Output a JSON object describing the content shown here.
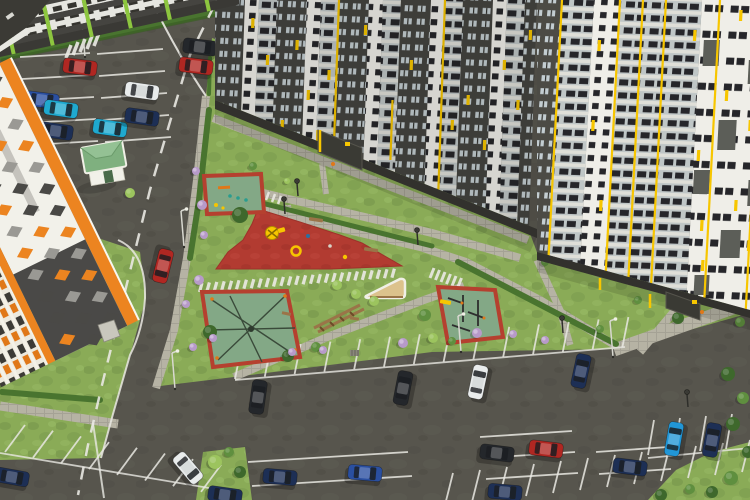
{
  "meta": {
    "description": "Aerial 3D architectural render of a residential complex: courtyard with red rubber playgrounds, sports courts, lawns, footpaths, a kiosk with a green roof, and two parking lots with cars between tall apartment towers",
    "image_type": "photorealistic-render",
    "visible_text": ""
  },
  "palette": {
    "asphalt": "#57554d",
    "asphalt_light": "#64625a",
    "grass": "#8aab57",
    "grass_dark": "#74944a",
    "grass_light": "#9cc06a",
    "hedge": "#49742f",
    "hedge_dark": "#3a5e24",
    "path": "#b6b3a4",
    "path_light": "#cecbbd",
    "line_white": "#e9e8e2",
    "red_surface": "#b23b31",
    "red_surface_dark": "#9e322a",
    "court_red": "#b5402f",
    "court_green": "#83a886",
    "sand": "#dcc28c",
    "wood": "#9a7448",
    "wood_dark": "#6b4c28",
    "tower_dark": "#454440",
    "tower_dark2": "#4c4b45",
    "tower_plinth": "#32312d",
    "tower_white": "#efeee8",
    "glass": "#c3cdd1",
    "balcony": "#bfc6c6",
    "balcony_slab": "#dfdfd8",
    "window_dark": "#26262a",
    "yellow": "#f7c600",
    "orange": "#ec8420",
    "lime": "#8dc63f",
    "kiosk_roof": "#7fb07f",
    "kiosk_roof_light": "#94c194",
    "kiosk_wall": "#f2f1e9",
    "car": {
      "red": "#b02722",
      "cyan": "#1fa9cf",
      "navy": "#1d2f55",
      "blue": "#2a4fa0",
      "white": "#e9ecec",
      "black": "#24272b",
      "skyblue": "#2196d6"
    },
    "veg": {
      "dark": "#3e682c",
      "mid": "#5f8f3f",
      "light": "#9cc45e",
      "lilac": "#b79ac9"
    }
  },
  "scene": {
    "buildings": [
      {
        "id": "left-tower",
        "style": "white facade, orange stripes, gray/orange diamond pattern, orange-and-dark window floors"
      },
      {
        "id": "lowrise-top",
        "style": "dark gray facade, white window bands, lime green vertical accents"
      },
      {
        "id": "center-tower",
        "style": "dark gray and white vertical sections, glazed balcony columns, yellow accents"
      },
      {
        "id": "right-tower",
        "style": "light facade, gray balcony bands, white piers, dark patches, yellow vertical stripes"
      },
      {
        "id": "kiosk",
        "style": "small white kiosk with green hip roof"
      }
    ],
    "courtyard": {
      "red_playground": "large red rubber play area with yellow climbing frame, ring, benches and toys",
      "kids_court": "small red-framed green court with bench and play items",
      "net_court": "red-framed green court with rope climbing nets",
      "workout_court": "red-framed green court with workout bars and bench",
      "sand_pit": "triangular sand pit with wooden edge",
      "obstacle": "wooden balance/obstacle beams on lawn"
    },
    "cars": [
      [
        80,
        67,
        7,
        "red"
      ],
      [
        196,
        66,
        7,
        "red"
      ],
      [
        200,
        47,
        7,
        "black"
      ],
      [
        42,
        100,
        7,
        "blue"
      ],
      [
        61,
        109,
        8,
        "cyan"
      ],
      [
        56,
        131,
        8,
        "navy"
      ],
      [
        110,
        128,
        8,
        "cyan"
      ],
      [
        142,
        91,
        8,
        "white"
      ],
      [
        142,
        117,
        8,
        "navy"
      ],
      [
        163,
        266,
        104,
        "red"
      ],
      [
        188,
        468,
        50,
        "white"
      ],
      [
        403,
        388,
        -79,
        "black"
      ],
      [
        581,
        371,
        -78,
        "navy"
      ],
      [
        478,
        382,
        -78,
        "white"
      ],
      [
        258,
        397,
        -82,
        "black"
      ],
      [
        280,
        477,
        5,
        "navy"
      ],
      [
        365,
        473,
        5,
        "blue"
      ],
      [
        546,
        449,
        7,
        "red"
      ],
      [
        497,
        453,
        7,
        "black"
      ],
      [
        674,
        439,
        -80,
        "skyblue"
      ],
      [
        712,
        440,
        -80,
        "navy"
      ],
      [
        630,
        467,
        7,
        "navy"
      ],
      [
        505,
        492,
        5,
        "navy"
      ],
      [
        225,
        495,
        8,
        "navy"
      ],
      [
        12,
        477,
        10,
        "navy"
      ]
    ],
    "vegetation": [
      [
        240,
        215,
        8,
        "dark"
      ],
      [
        210,
        332,
        7,
        "dark"
      ],
      [
        288,
        356,
        6,
        "dark"
      ],
      [
        316,
        347,
        5,
        "mid"
      ],
      [
        678,
        318,
        6,
        "dark"
      ],
      [
        740,
        322,
        5,
        "mid"
      ],
      [
        728,
        374,
        7,
        "dark"
      ],
      [
        743,
        398,
        6,
        "mid"
      ],
      [
        733,
        424,
        7,
        "dark"
      ],
      [
        748,
        452,
        6,
        "dark"
      ],
      [
        731,
        478,
        7,
        "mid"
      ],
      [
        712,
        492,
        6,
        "dark"
      ],
      [
        690,
        489,
        5,
        "mid"
      ],
      [
        661,
        495,
        6,
        "dark"
      ],
      [
        196,
        171,
        4,
        "lilac"
      ],
      [
        202,
        205,
        5,
        "lilac"
      ],
      [
        204,
        235,
        4,
        "lilac"
      ],
      [
        199,
        280,
        5,
        "lilac"
      ],
      [
        213,
        338,
        4,
        "lilac"
      ],
      [
        292,
        352,
        4,
        "lilac"
      ],
      [
        323,
        350,
        4,
        "lilac"
      ],
      [
        403,
        343,
        5,
        "lilac"
      ],
      [
        477,
        333,
        5,
        "lilac"
      ],
      [
        513,
        334,
        4,
        "lilac"
      ],
      [
        186,
        304,
        4,
        "lilac"
      ],
      [
        193,
        347,
        4,
        "lilac"
      ],
      [
        545,
        340,
        4,
        "lilac"
      ],
      [
        337,
        285,
        5,
        "light"
      ],
      [
        356,
        294,
        5,
        "light"
      ],
      [
        374,
        301,
        5,
        "light"
      ],
      [
        433,
        338,
        5,
        "light"
      ],
      [
        452,
        341,
        4,
        "mid"
      ],
      [
        545,
        262,
        4,
        "mid"
      ],
      [
        638,
        300,
        4,
        "mid"
      ],
      [
        253,
        166,
        4,
        "mid"
      ],
      [
        130,
        193,
        5,
        "light"
      ],
      [
        425,
        315,
        6,
        "mid"
      ],
      [
        115,
        300,
        6,
        "mid"
      ],
      [
        86,
        330,
        5,
        "light"
      ],
      [
        215,
        462,
        7,
        "light"
      ],
      [
        229,
        452,
        5,
        "mid"
      ],
      [
        240,
        472,
        6,
        "dark"
      ],
      [
        287,
        181,
        3,
        "light"
      ],
      [
        600,
        329,
        4,
        "mid"
      ]
    ],
    "lamps": {
      "mast": [
        [
          85,
          57
        ],
        [
          184,
          247
        ],
        [
          175,
          389
        ],
        [
          613,
          357
        ],
        [
          461,
          352
        ]
      ],
      "park": [
        [
          285,
          214
        ],
        [
          418,
          245
        ],
        [
          563,
          333
        ],
        [
          688,
          407
        ],
        [
          298,
          196
        ]
      ]
    },
    "parking": {
      "rows": [
        [
          20,
          57,
          90,
          53,
          5,
          2,
          22
        ],
        [
          97,
          54,
          163,
          49,
          5,
          2,
          22
        ],
        [
          235,
          379,
          241,
          349,
          14,
          29.8,
          -2.46
        ],
        [
          5,
          452,
          25,
          425,
          8,
          28,
          5.7
        ],
        [
          648,
          455,
          654,
          420,
          5,
          26,
          -2
        ],
        [
          480,
          437,
          572,
          431,
          3,
          3,
          21
        ],
        [
          596,
          452,
          668,
          447,
          2,
          3,
          22
        ],
        [
          248,
          462,
          408,
          452,
          2,
          4,
          24
        ],
        [
          445,
          505,
          453,
          473,
          12,
          27,
          -3
        ]
      ],
      "baselines": [
        [
          235,
          380,
          625,
          347
        ],
        [
          0,
          453,
          233,
          492
        ],
        [
          648,
          458,
          750,
          448
        ]
      ]
    },
    "markings": {
      "dash_line": "214,6 190,55 172,115 150,190 134,255 118,320 102,385 88,445 78,495",
      "zebras": [
        [
          202,
          283,
          7.4,
          -0.55,
          -2.5,
          9,
          27,
          3.2
        ],
        [
          66,
          58,
          7,
          -3,
          5,
          -13,
          5,
          3.5
        ],
        [
          434,
          268,
          5.5,
          2.0,
          -4,
          10,
          6,
          3
        ],
        [
          263,
          190,
          6,
          2,
          -3,
          8,
          4,
          2.5
        ]
      ]
    },
    "facades": {
      "center_cols": [
        [
          215,
          30,
          "Dark"
        ],
        [
          245,
          14,
          "White"
        ],
        [
          259,
          18,
          "Balc"
        ],
        [
          277,
          30,
          "Dark"
        ],
        [
          307,
          14,
          "White"
        ],
        [
          321,
          18,
          "Balc"
        ],
        [
          339,
          30,
          "Dark"
        ],
        [
          369,
          14,
          "White"
        ],
        [
          383,
          18,
          "Balc"
        ],
        [
          401,
          30,
          "Dark"
        ],
        [
          431,
          14,
          "White"
        ],
        [
          445,
          18,
          "Balc"
        ],
        [
          463,
          30,
          "Dark"
        ],
        [
          493,
          14,
          "White"
        ],
        [
          507,
          18,
          "Balc"
        ],
        [
          525,
          12,
          "Dark"
        ]
      ],
      "right_cols": [
        [
          537,
          25,
          "Dark2"
        ],
        [
          562,
          32,
          "Balc"
        ],
        [
          594,
          26,
          "White"
        ],
        [
          620,
          82,
          "Balc"
        ],
        [
          702,
          68,
          "WhiteBig"
        ]
      ],
      "center_accents": [
        [
          252,
          18
        ],
        [
          268,
          55
        ],
        [
          297,
          40
        ],
        [
          310,
          90
        ],
        [
          250,
          130
        ],
        [
          365,
          25
        ],
        [
          412,
          60
        ],
        [
          470,
          95
        ],
        [
          488,
          140
        ],
        [
          505,
          60
        ],
        [
          530,
          30
        ],
        [
          285,
          120
        ],
        [
          330,
          70
        ],
        [
          455,
          120
        ],
        [
          520,
          100
        ]
      ],
      "center_lines": [
        [
          339,
          0,
          148
        ],
        [
          445,
          0,
          190
        ],
        [
          322,
          130,
          152
        ],
        [
          396,
          100,
          160
        ]
      ],
      "right_accents": [
        [
          600,
          40
        ],
        [
          598,
          120
        ],
        [
          610,
          200
        ],
        [
          695,
          30
        ],
        [
          705,
          150
        ],
        [
          715,
          260
        ],
        [
          730,
          90
        ],
        [
          745,
          200
        ],
        [
          740,
          10
        ],
        [
          712,
          220
        ],
        [
          755,
          120
        ],
        [
          760,
          240
        ]
      ],
      "right_patches": [
        [
          706,
          40,
          16,
          26
        ],
        [
          725,
          120,
          18,
          30
        ],
        [
          703,
          170,
          16,
          24
        ],
        [
          733,
          230,
          20,
          28
        ],
        [
          709,
          275,
          15,
          20
        ],
        [
          752,
          60,
          16,
          24
        ],
        [
          758,
          180,
          16,
          26
        ]
      ],
      "right_lines": [
        [
          562,
          0,
          257
        ],
        [
          620,
          0,
          272
        ],
        [
          643,
          0,
          281
        ],
        [
          666,
          0,
          288
        ],
        [
          720,
          0,
          300
        ],
        [
          762,
          0,
          310
        ]
      ],
      "left_diamonds": {
        "rows": [
          24,
          48,
          72
        ],
        "x0": 14,
        "step": 24,
        "n": 12,
        "size": 9,
        "colors": [
          "dark",
          "orange",
          "gray",
          "orange",
          "gray",
          "dark"
        ]
      }
    }
  }
}
